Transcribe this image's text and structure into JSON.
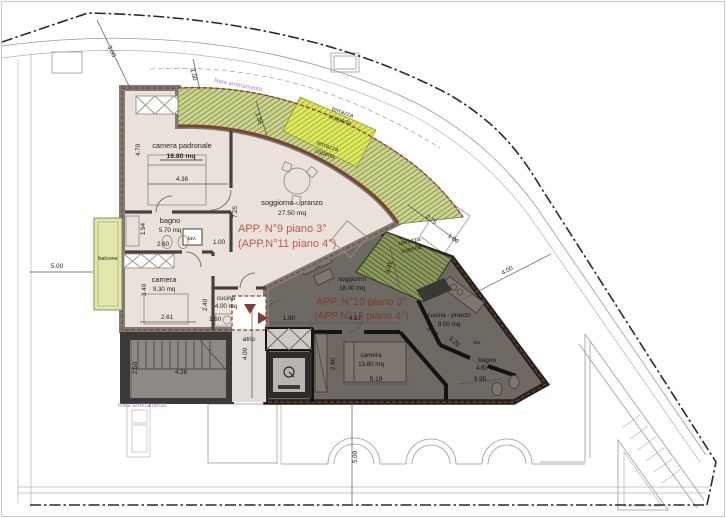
{
  "document": {
    "kind": "architectural floor plan (third/fourth floor apartments)"
  },
  "site": {
    "setback_label": "linea arretramento"
  },
  "apartments": [
    {
      "id": "app9",
      "title_line1": "APP. N°9 piano 3°",
      "title_line2": "(APP.N°11 piano 4°)",
      "rooms": [
        {
          "name": "camera padronale",
          "area": "16.80 mq"
        },
        {
          "name": "bagno",
          "area": "5.70 mq"
        },
        {
          "name": "camera",
          "area": "9.30 mq"
        },
        {
          "name": "cucina",
          "area": "4.00 mq"
        },
        {
          "name": "soggiorno - pranzo",
          "area": "27.50 mq"
        }
      ]
    },
    {
      "id": "app10",
      "title_line1": "APP. N°10 piano 3°",
      "title_line2": "(APP.N°12 piano 4°)",
      "rooms": [
        {
          "name": "soggiorno",
          "area": "18.00 mq"
        },
        {
          "name": "cucina - pranzo",
          "area": "9.00 mq"
        },
        {
          "name": "camera",
          "area": "13.80 mq"
        },
        {
          "name": "bagno",
          "area": "4.60 mq"
        }
      ]
    }
  ],
  "common_areas": {
    "atrio": "atrio",
    "lav_app9": "lav.",
    "lav_app10": "lav",
    "balcone": "balcone"
  },
  "outdoor": {
    "terrazza_scoperta_line1": "terrazza",
    "terrazza_scoperta_line2": "scoperta",
    "terrazza_coperta_line1": "terrazza",
    "terrazza_coperta_line2": "coperta"
  },
  "dimensions": {
    "d_3_00": "3.00",
    "d_1_00_top": "1.00",
    "d_1_96": "1.96",
    "d_4_70": "4.70",
    "d_4_36_camera": "4.36",
    "d_1_94": "1.94",
    "d_2_60": "2.60",
    "d_1_00_bagno": "1.00",
    "d_3_40": "3.40",
    "d_2_61": "2.61",
    "d_2_40": "2.40",
    "d_1_60": "1.60",
    "d_7_25": "7.25",
    "d_5_00_left": "5.00",
    "d_2_50": "2.50",
    "d_4_36_stairs": "4.36",
    "d_4_00_atrio": "4.00",
    "d_1_80": "1.80",
    "d_4_17": "4.17",
    "d_2_90": "2.90",
    "d_5_19": "5.19",
    "d_3_41": "3.41",
    "d_2_75": "2.75",
    "d_1_00_terrace": "1.00",
    "d_3_60": "3.60",
    "d_3_20": "3.20",
    "d_3_95": "3.95",
    "d_4_00_right": "4.00",
    "d_5_00_bottom": "5.00"
  },
  "colors": {
    "app9_floor": "#eae1da",
    "app10_floor": "#6f6963",
    "terrace_open": "#dfe960",
    "terrace_covered": "#cdd492",
    "terrace_covered_dark": "#8d9960",
    "balcony": "#e3e7ac",
    "title_red_app9": "#bc5a49",
    "title_red_app10": "#7c3a31",
    "setback_purple": "#a97fc2",
    "boundary_trim_red": "#93402f"
  }
}
